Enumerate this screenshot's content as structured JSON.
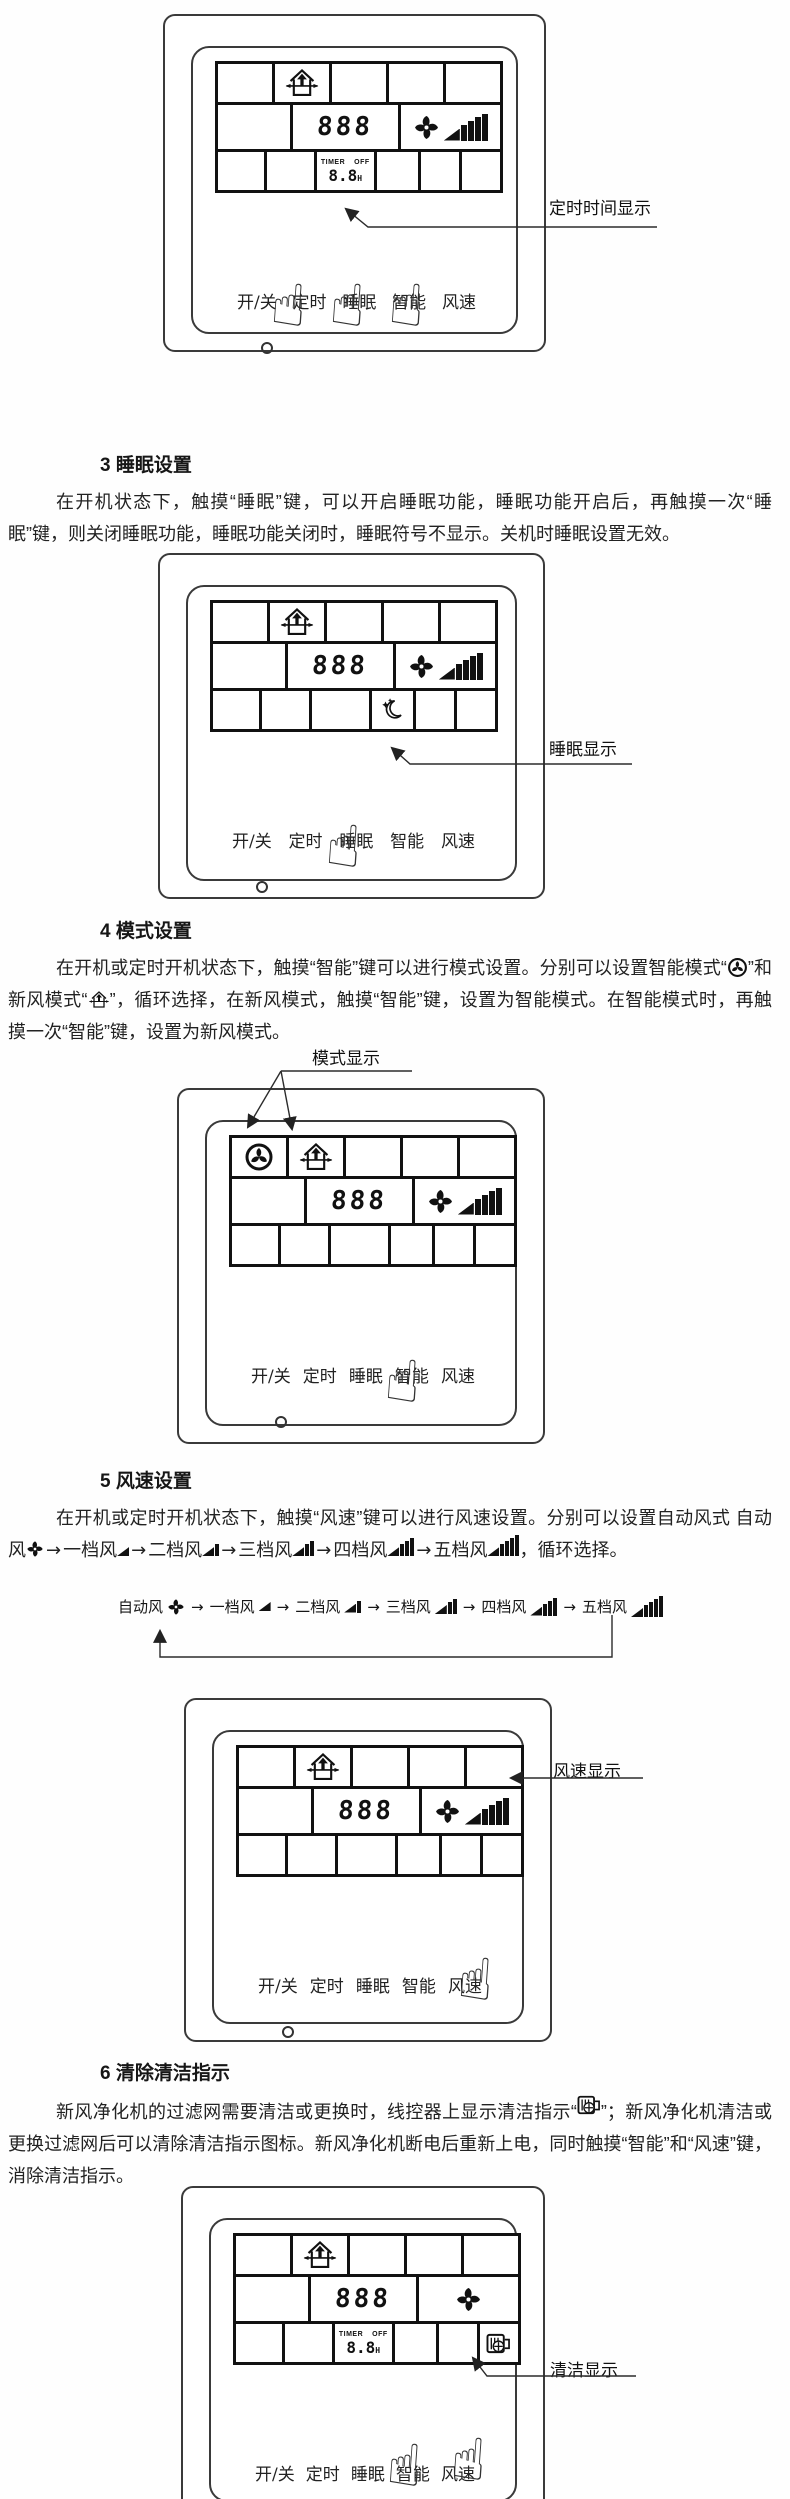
{
  "controller_buttons": [
    "开/关",
    "定时",
    "睡眠",
    "智能",
    "风速"
  ],
  "lcd": {
    "digits": "888",
    "timer_label": "TIMER",
    "timer_off": "OFF",
    "timer_value": "8.8",
    "timer_unit": "H"
  },
  "annotations": {
    "timer_display": "定时时间显示",
    "sleep_display": "睡眠显示",
    "mode_display": "模式显示",
    "fan_display": "风速显示",
    "clean_display": "清洁显示"
  },
  "sections": {
    "s3": {
      "heading": "3 睡眠设置",
      "body": "在开机状态下，触摸“睡眠”键，可以开启睡眠功能，睡眠功能开启后，再触摸一次“睡眠”键，则关闭睡眠功能，睡眠功能关闭时，睡眠符号不显示。关机时睡眠设置无效。"
    },
    "s4": {
      "heading": "4 模式设置",
      "body_1": "在开机或定时开机状态下，触摸“智能”键可以进行模式设置。分别可以设置智能模式“",
      "body_2": "”和新风模式“",
      "body_3": "”，循环选择，在新风模式，触摸“智能”键，设置为智能模式。在智能模式时，再触摸一次“智能”键，设置为新风模式。"
    },
    "s5": {
      "heading": "5 风速设置",
      "body_1": "在开机或定时开机状态下，触摸“风速”键可以进行风速设置。分别可以设置自动风式",
      "comma": "，",
      "body_2": "循环选择。"
    },
    "s6": {
      "heading": "6 清除清洁指示",
      "body_1": "新风净化机的过滤网需要清洁或更换时，线控器上显示清洁指示“",
      "body_2": "”；新风净化机清洁或更换过滤网后可以清除清洁指示图标。新风净化机断电后重新上电，同时触摸“智能”和“风速”键，消除清洁指示。"
    }
  },
  "speeds": {
    "auto": "自动风",
    "s1": "一档风",
    "s2": "二档风",
    "s3": "三档风",
    "s4": "四档风",
    "s5": "五档风"
  }
}
